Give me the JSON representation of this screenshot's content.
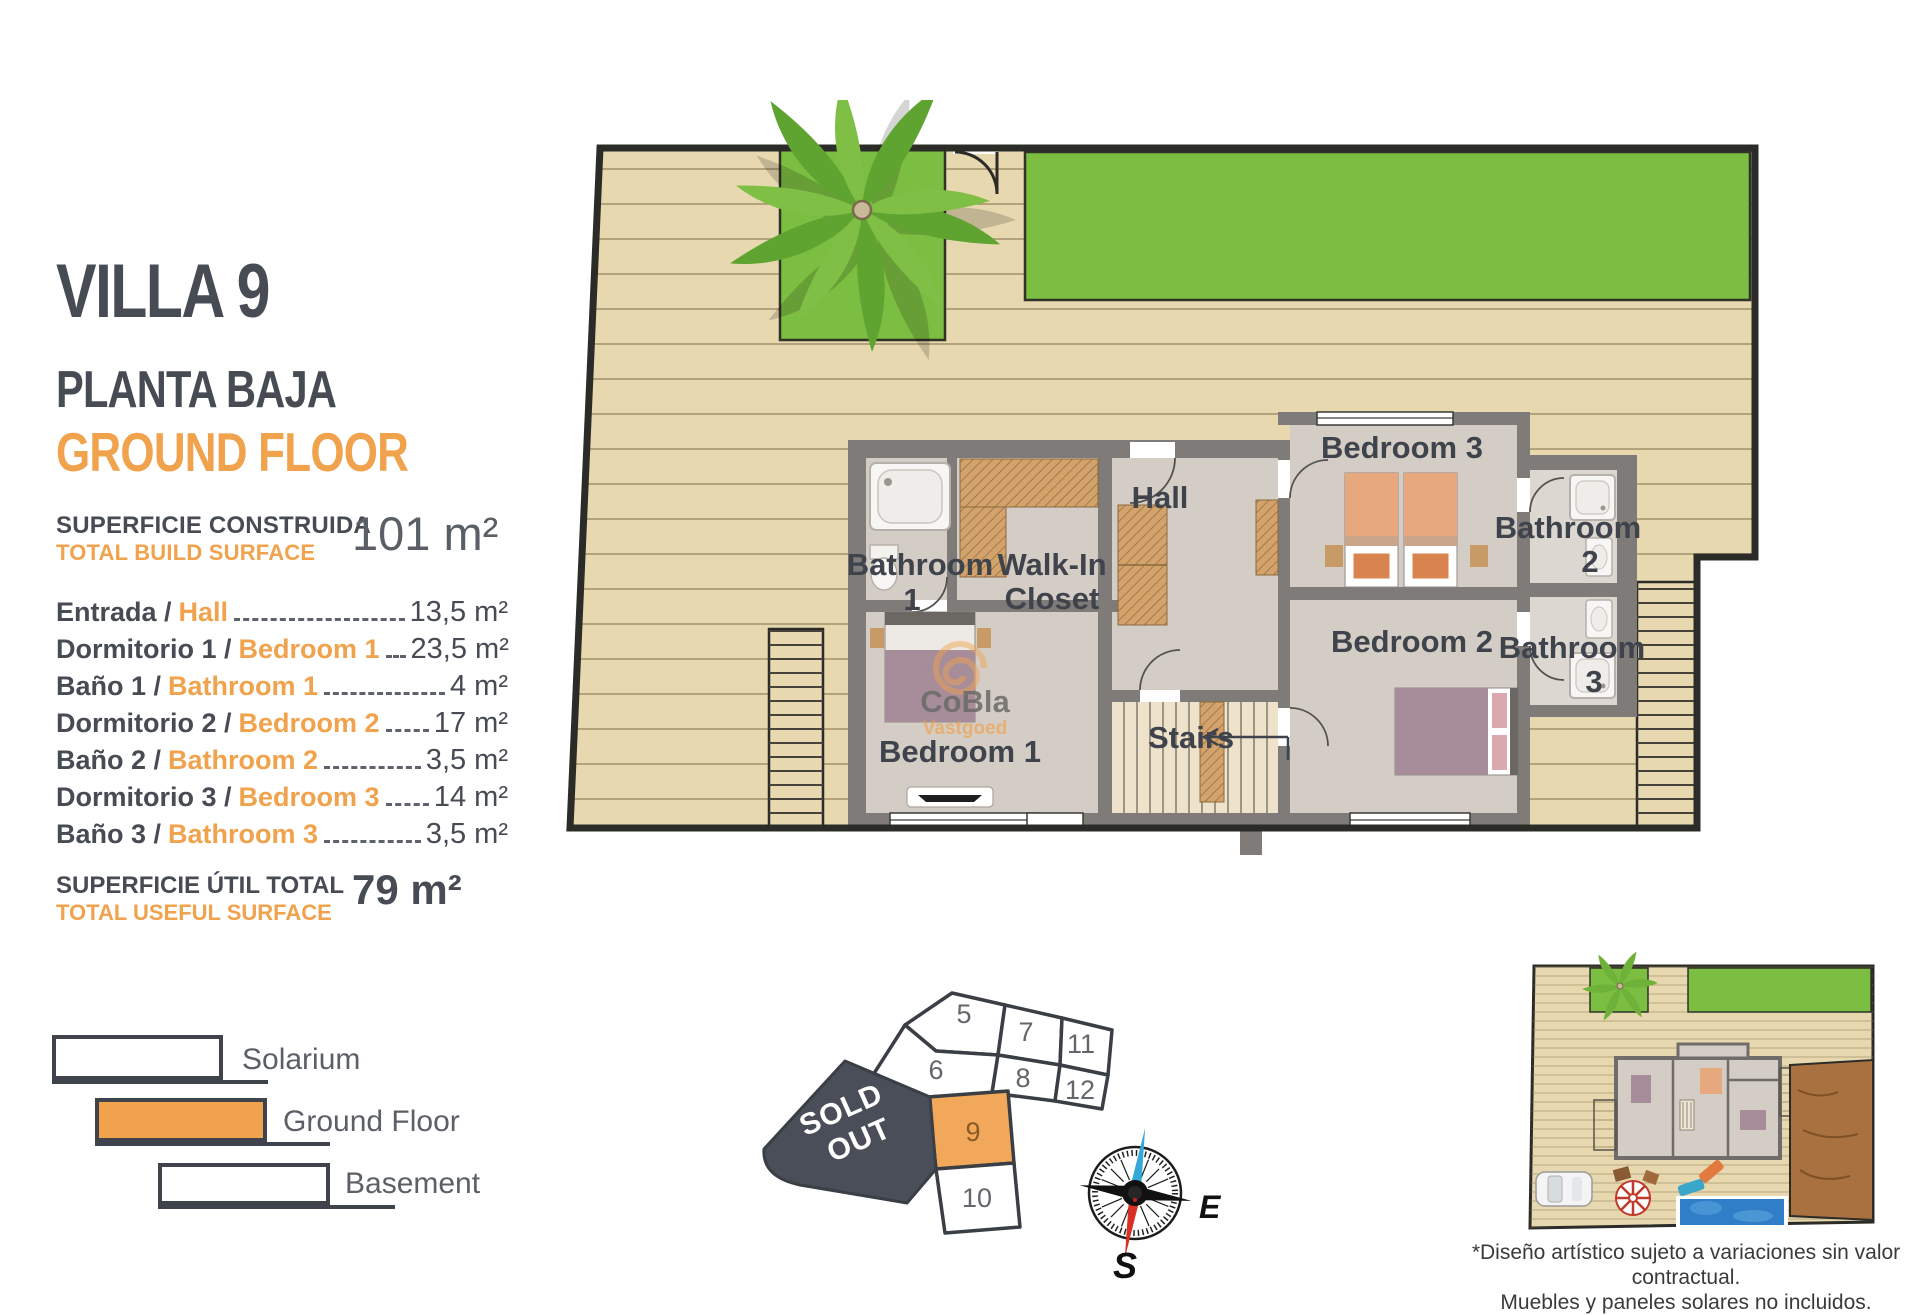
{
  "panel": {
    "title": "VILLA 9",
    "subtitle_es": "PLANTA BAJA",
    "subtitle_en": "GROUND FLOOR",
    "build": {
      "label_es": "SUPERFICIE CONSTRUIDA",
      "label_en": "TOTAL BUILD SURFACE",
      "value": "101 m²"
    },
    "rooms": [
      {
        "es": "Entrada /",
        "en": "Hall",
        "area": "13,5 m²"
      },
      {
        "es": "Dormitorio 1 /",
        "en": "Bedroom 1",
        "area": "23,5 m²"
      },
      {
        "es": "Baño 1 /",
        "en": "Bathroom 1",
        "area": "4 m²"
      },
      {
        "es": "Dormitorio 2 /",
        "en": "Bedroom 2",
        "area": "17 m²"
      },
      {
        "es": "Baño 2 /",
        "en": "Bathroom 2",
        "area": "3,5 m²"
      },
      {
        "es": "Dormitorio 3 /",
        "en": "Bedroom 3",
        "area": "14 m²"
      },
      {
        "es": "Baño 3 /",
        "en": "Bathroom 3",
        "area": "3,5 m²"
      }
    ],
    "useful": {
      "label_es": "SUPERFICIE ÚTIL TOTAL",
      "label_en": "TOTAL USEFUL SURFACE",
      "value": "79 m²"
    },
    "legend": [
      {
        "label": "Solarium"
      },
      {
        "label": "Ground Floor"
      },
      {
        "label": "Basement"
      }
    ]
  },
  "floorplan": {
    "labels": {
      "hall": "Hall",
      "bathroom1": [
        "Bathroom",
        "1"
      ],
      "walkin": [
        "Walk-In",
        "Closet"
      ],
      "bedroom3": "Bedroom 3",
      "bathroom2": [
        "Bathroom",
        "2"
      ],
      "bathroom3": [
        "Bathroom",
        "3"
      ],
      "bedroom2": "Bedroom 2",
      "bedroom1": "Bedroom 1",
      "stairs": "Stairs"
    },
    "watermark": [
      "CoBla",
      "Vastgoed"
    ]
  },
  "plot_map": {
    "plots": [
      "5",
      "7",
      "11",
      "6",
      "8",
      "12",
      "9",
      "10"
    ],
    "highlighted_plot": "9",
    "sold_out": [
      "SOLD",
      "OUT"
    ]
  },
  "compass": {
    "east": "E",
    "south": "S"
  },
  "disclaimer": [
    "*Diseño artístico sujeto a variaciones sin valor contractual.",
    "Muebles y paneles solares no incluidos."
  ],
  "colors": {
    "accent": "#F0A24C",
    "dark": "#474B54",
    "deck": "#E7D8B0",
    "plank": "#8E7F55",
    "grass": "#7CBE41",
    "wall": "#7E7B78",
    "floor": "#D4CDC6",
    "stairfloor": "#EFE2CB",
    "tan": "#D3A36B",
    "mauve": "#A78D9A",
    "salmon": "#E8A87E",
    "pool": "#2F7EC7"
  }
}
